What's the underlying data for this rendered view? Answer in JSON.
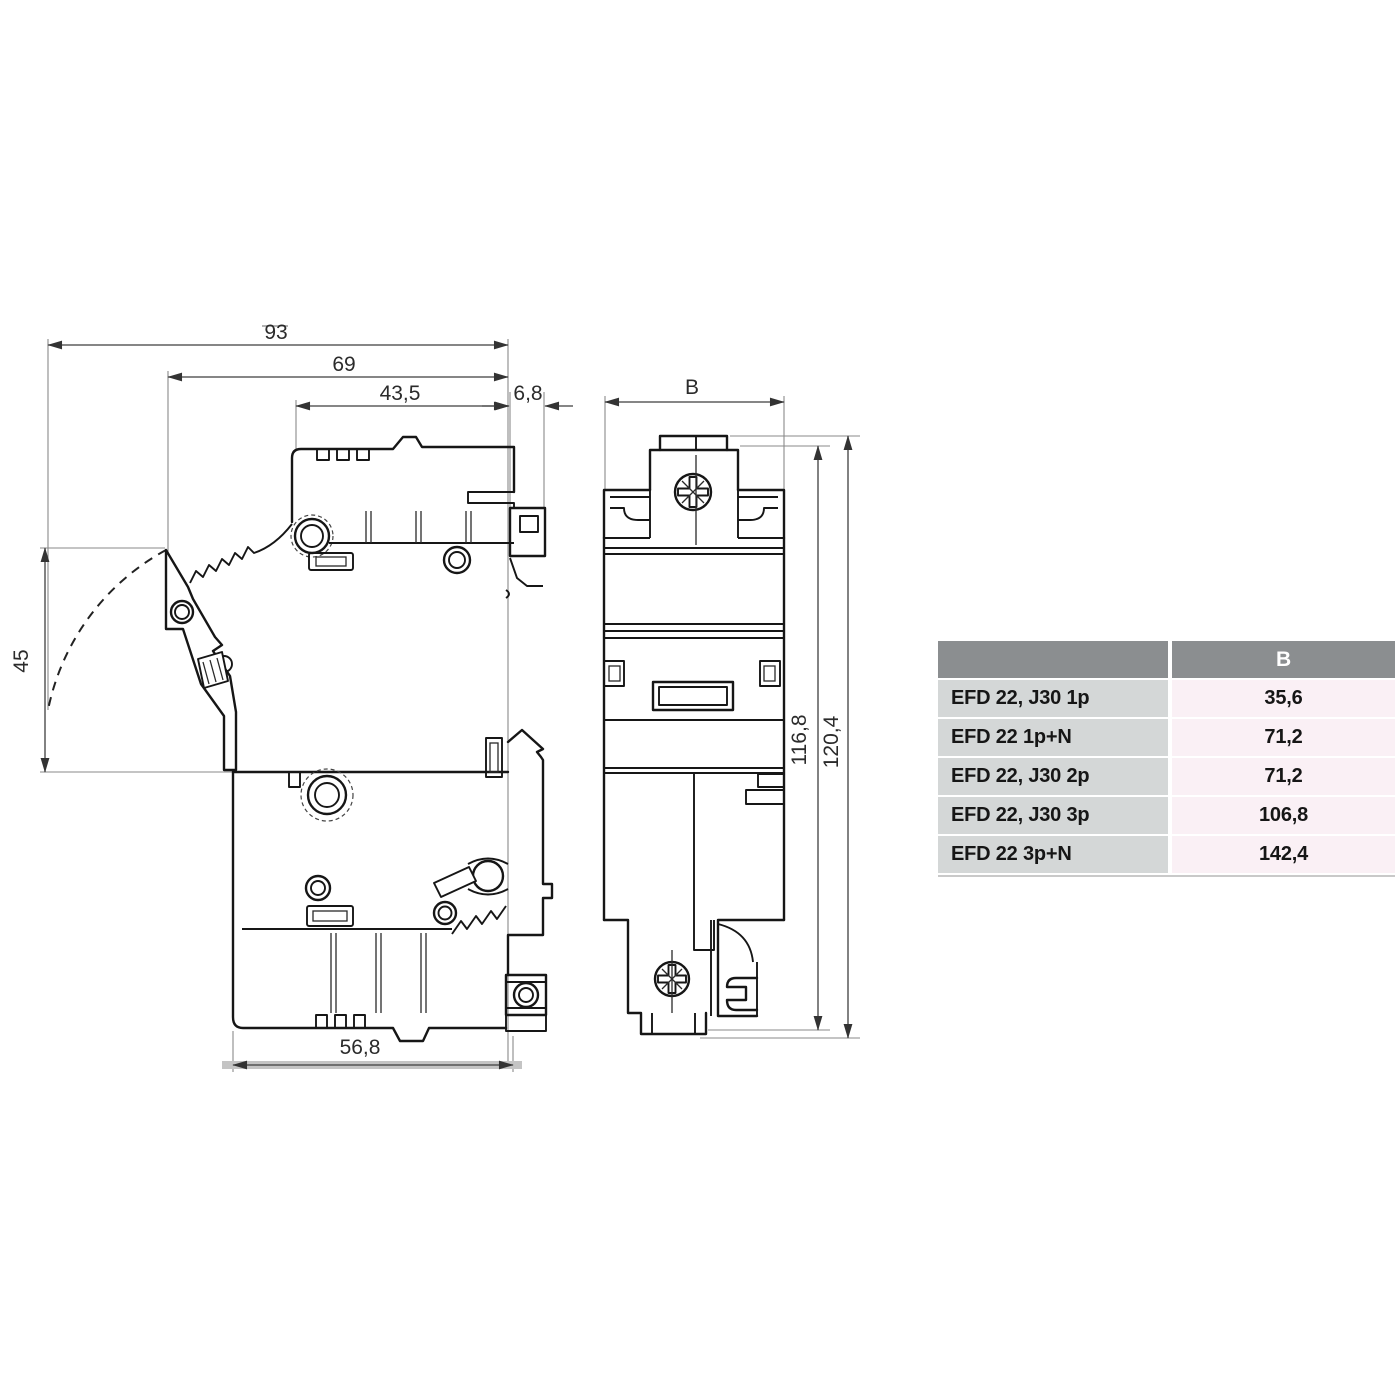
{
  "drawing": {
    "type": "dimensional technical drawing, fuse disconnector EFD 22",
    "units": "mm",
    "side_view": {
      "dims": {
        "overall_depth": "93",
        "handle_depth": "69",
        "upper_body_depth": "43,5",
        "rail_claw_depth": "6,8",
        "handle_travel": "45",
        "base_depth": "56,8"
      }
    },
    "front_view": {
      "dims": {
        "width": "B",
        "body_height": "116,8",
        "overall_height": "120,4"
      }
    },
    "colors": {
      "line": "#161616",
      "dimension_line": "#3f3f3f",
      "rail_band": "#c4c4c4"
    }
  },
  "table": {
    "header": {
      "model": "",
      "width_b": "B"
    },
    "rows": [
      {
        "model": "EFD 22, J30 1p",
        "width_b": "35,6"
      },
      {
        "model": "EFD 22 1p+N",
        "width_b": "71,2"
      },
      {
        "model": "EFD 22, J30 2p",
        "width_b": "71,2"
      },
      {
        "model": "EFD 22, J30 3p",
        "width_b": "106,8"
      },
      {
        "model": "EFD 22 3p+N",
        "width_b": "142,4"
      }
    ],
    "colors": {
      "header_bg": "#8b8e90",
      "header_text": "#ffffff",
      "model_cell_bg": "#d4d7d7",
      "value_cell_bg": "#faf0f5",
      "text": "#161616"
    }
  }
}
